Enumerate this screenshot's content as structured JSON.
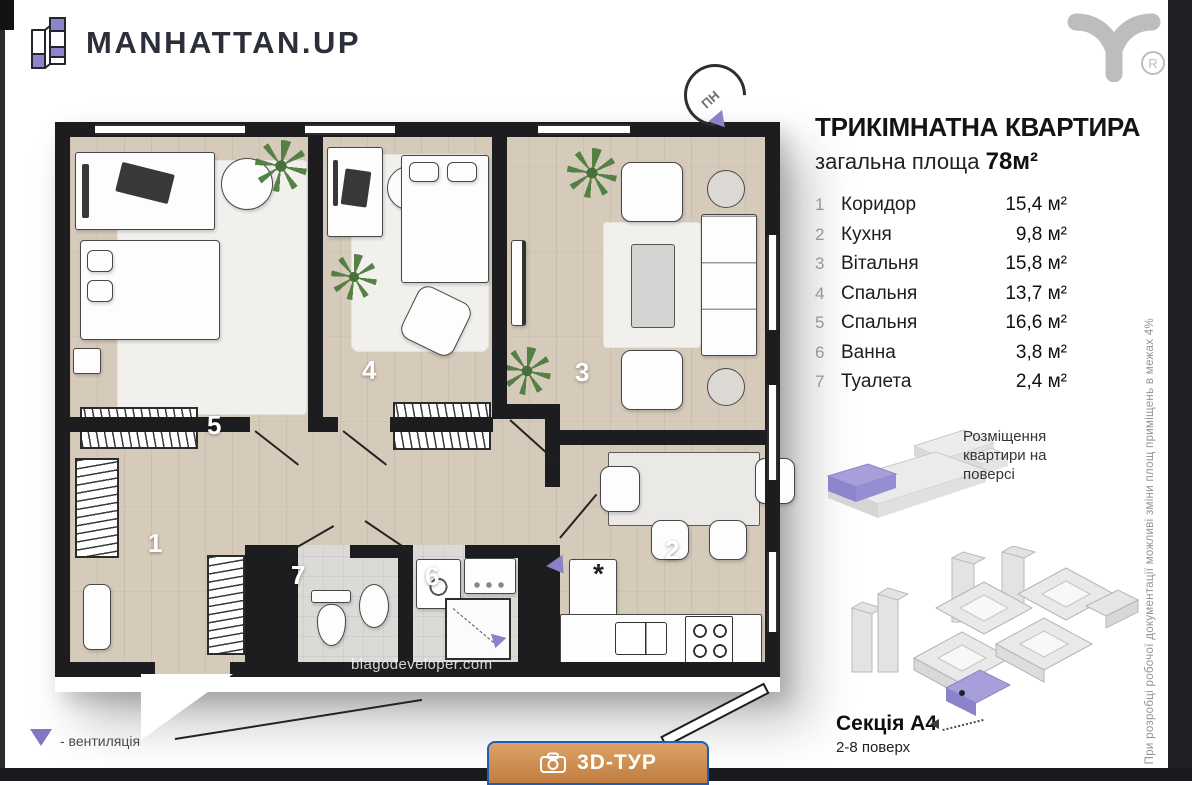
{
  "brand": {
    "name": "MANHATTAN.UP",
    "mark": "®"
  },
  "compass": {
    "north_label": "ПН"
  },
  "apartment": {
    "title": "ТРИКІМНАТНА КВАРТИРА",
    "area_label": "загальна площа",
    "area_value": "78м²"
  },
  "rooms": [
    {
      "num": "1",
      "name": "Коридор",
      "area": "15,4 м²"
    },
    {
      "num": "2",
      "name": "Кухня",
      "area": "9,8 м²"
    },
    {
      "num": "3",
      "name": "Вітальня",
      "area": "15,8 м²"
    },
    {
      "num": "4",
      "name": "Спальня",
      "area": "13,7 м²"
    },
    {
      "num": "5",
      "name": "Спальня",
      "area": "16,6 м²"
    },
    {
      "num": "6",
      "name": "Ванна",
      "area": "3,8 м²"
    },
    {
      "num": "7",
      "name": "Туалета",
      "area": "2,4 м²"
    }
  ],
  "floor_diagram": {
    "caption": "Розміщення квартири на поверсі"
  },
  "building_diagram": {
    "section_label": "Секція А4",
    "floors_label": "2-8 поверх"
  },
  "legend": {
    "ventilation_label": "- вентиляція"
  },
  "plan": {
    "watermark": "blagodeveloper.com",
    "kitchen_symbol": "*"
  },
  "disclaimer": "При розробці робочої документації можливі зміни площ приміщень в межах 4%",
  "cta": {
    "label": "3D-ТУР"
  },
  "colors": {
    "accent_purple": "#8A82C9",
    "wall_black": "#1d1d1f",
    "wood_floor": "#d6cabb",
    "tile_floor": "#dbdad7",
    "cta_orange": "#cf8f53",
    "cta_border": "#1d5fb8"
  }
}
